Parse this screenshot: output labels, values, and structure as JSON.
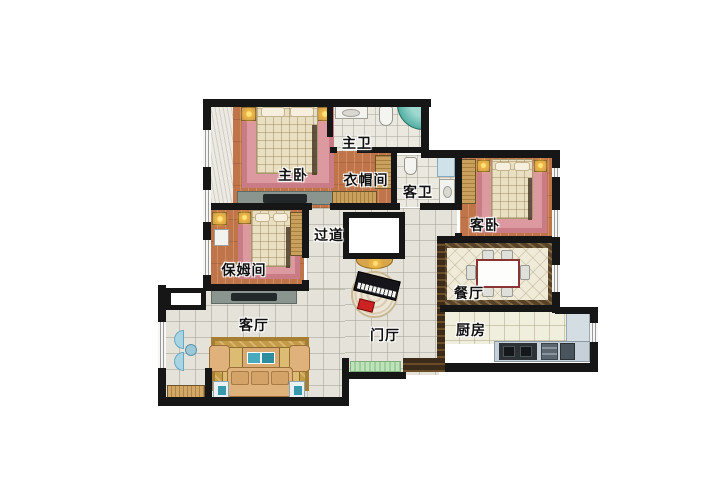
{
  "floorplan": {
    "rooms": [
      {
        "id": "master-bedroom",
        "label": "主卧",
        "floor": "wood"
      },
      {
        "id": "master-bathroom",
        "label": "主卫",
        "floor": "bath-tile"
      },
      {
        "id": "walk-in-closet",
        "label": "衣帽间",
        "floor": "wood"
      },
      {
        "id": "guest-bathroom",
        "label": "客卫",
        "floor": "bath-tile"
      },
      {
        "id": "guest-bedroom",
        "label": "客卧",
        "floor": "wood"
      },
      {
        "id": "hallway",
        "label": "过道",
        "floor": "tile"
      },
      {
        "id": "nanny-room",
        "label": "保姆间",
        "floor": "wood"
      },
      {
        "id": "dining-room",
        "label": "餐厅",
        "floor": "marble-bordered-tile"
      },
      {
        "id": "kitchen",
        "label": "厨房",
        "floor": "kitchen-tile"
      },
      {
        "id": "living-room",
        "label": "客厅",
        "floor": "tile"
      },
      {
        "id": "foyer",
        "label": "门厅",
        "floor": "tile"
      }
    ],
    "colors": {
      "wall": "#161616",
      "wood_floor": "#bf7449",
      "pink_rug": "#dc99a0",
      "hall_tile": "#e4e2d9",
      "kitchen_tile": "#f0eedd",
      "marble_border": "#57432a",
      "gold_rug": "#c59b48",
      "teal_accent": "#3fa9bc",
      "lamp_glow": "#ffd34d",
      "entry_mat_green": "#9ccf9a",
      "piano_bench_red": "#cc2222"
    }
  }
}
